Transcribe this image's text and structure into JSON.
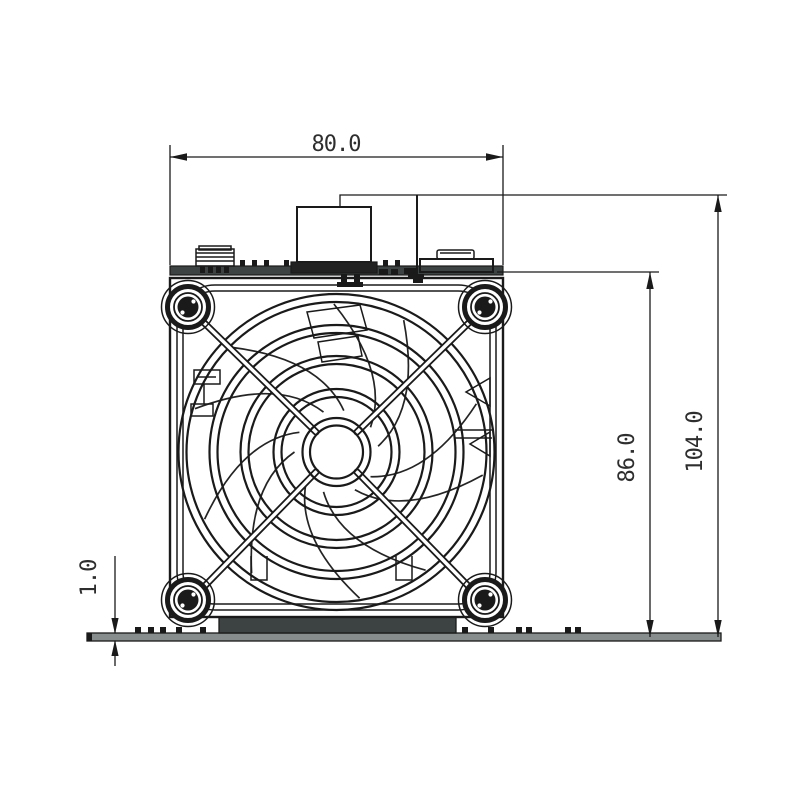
{
  "drawing": {
    "dimensions": {
      "width": {
        "value": "80.0",
        "orientation": "horizontal"
      },
      "overall_height": {
        "value": "104.0",
        "orientation": "vertical"
      },
      "body_height": {
        "value": "86.0",
        "orientation": "vertical"
      },
      "base_plate_thickness": {
        "value": "1.0",
        "orientation": "vertical"
      }
    },
    "colors": {
      "line": "#1a1a1a",
      "background": "#ffffff",
      "top_plate_fill": "#3d4242",
      "gasket_fill": "#3d4242",
      "base_plate_fill": "#878c8c"
    }
  }
}
